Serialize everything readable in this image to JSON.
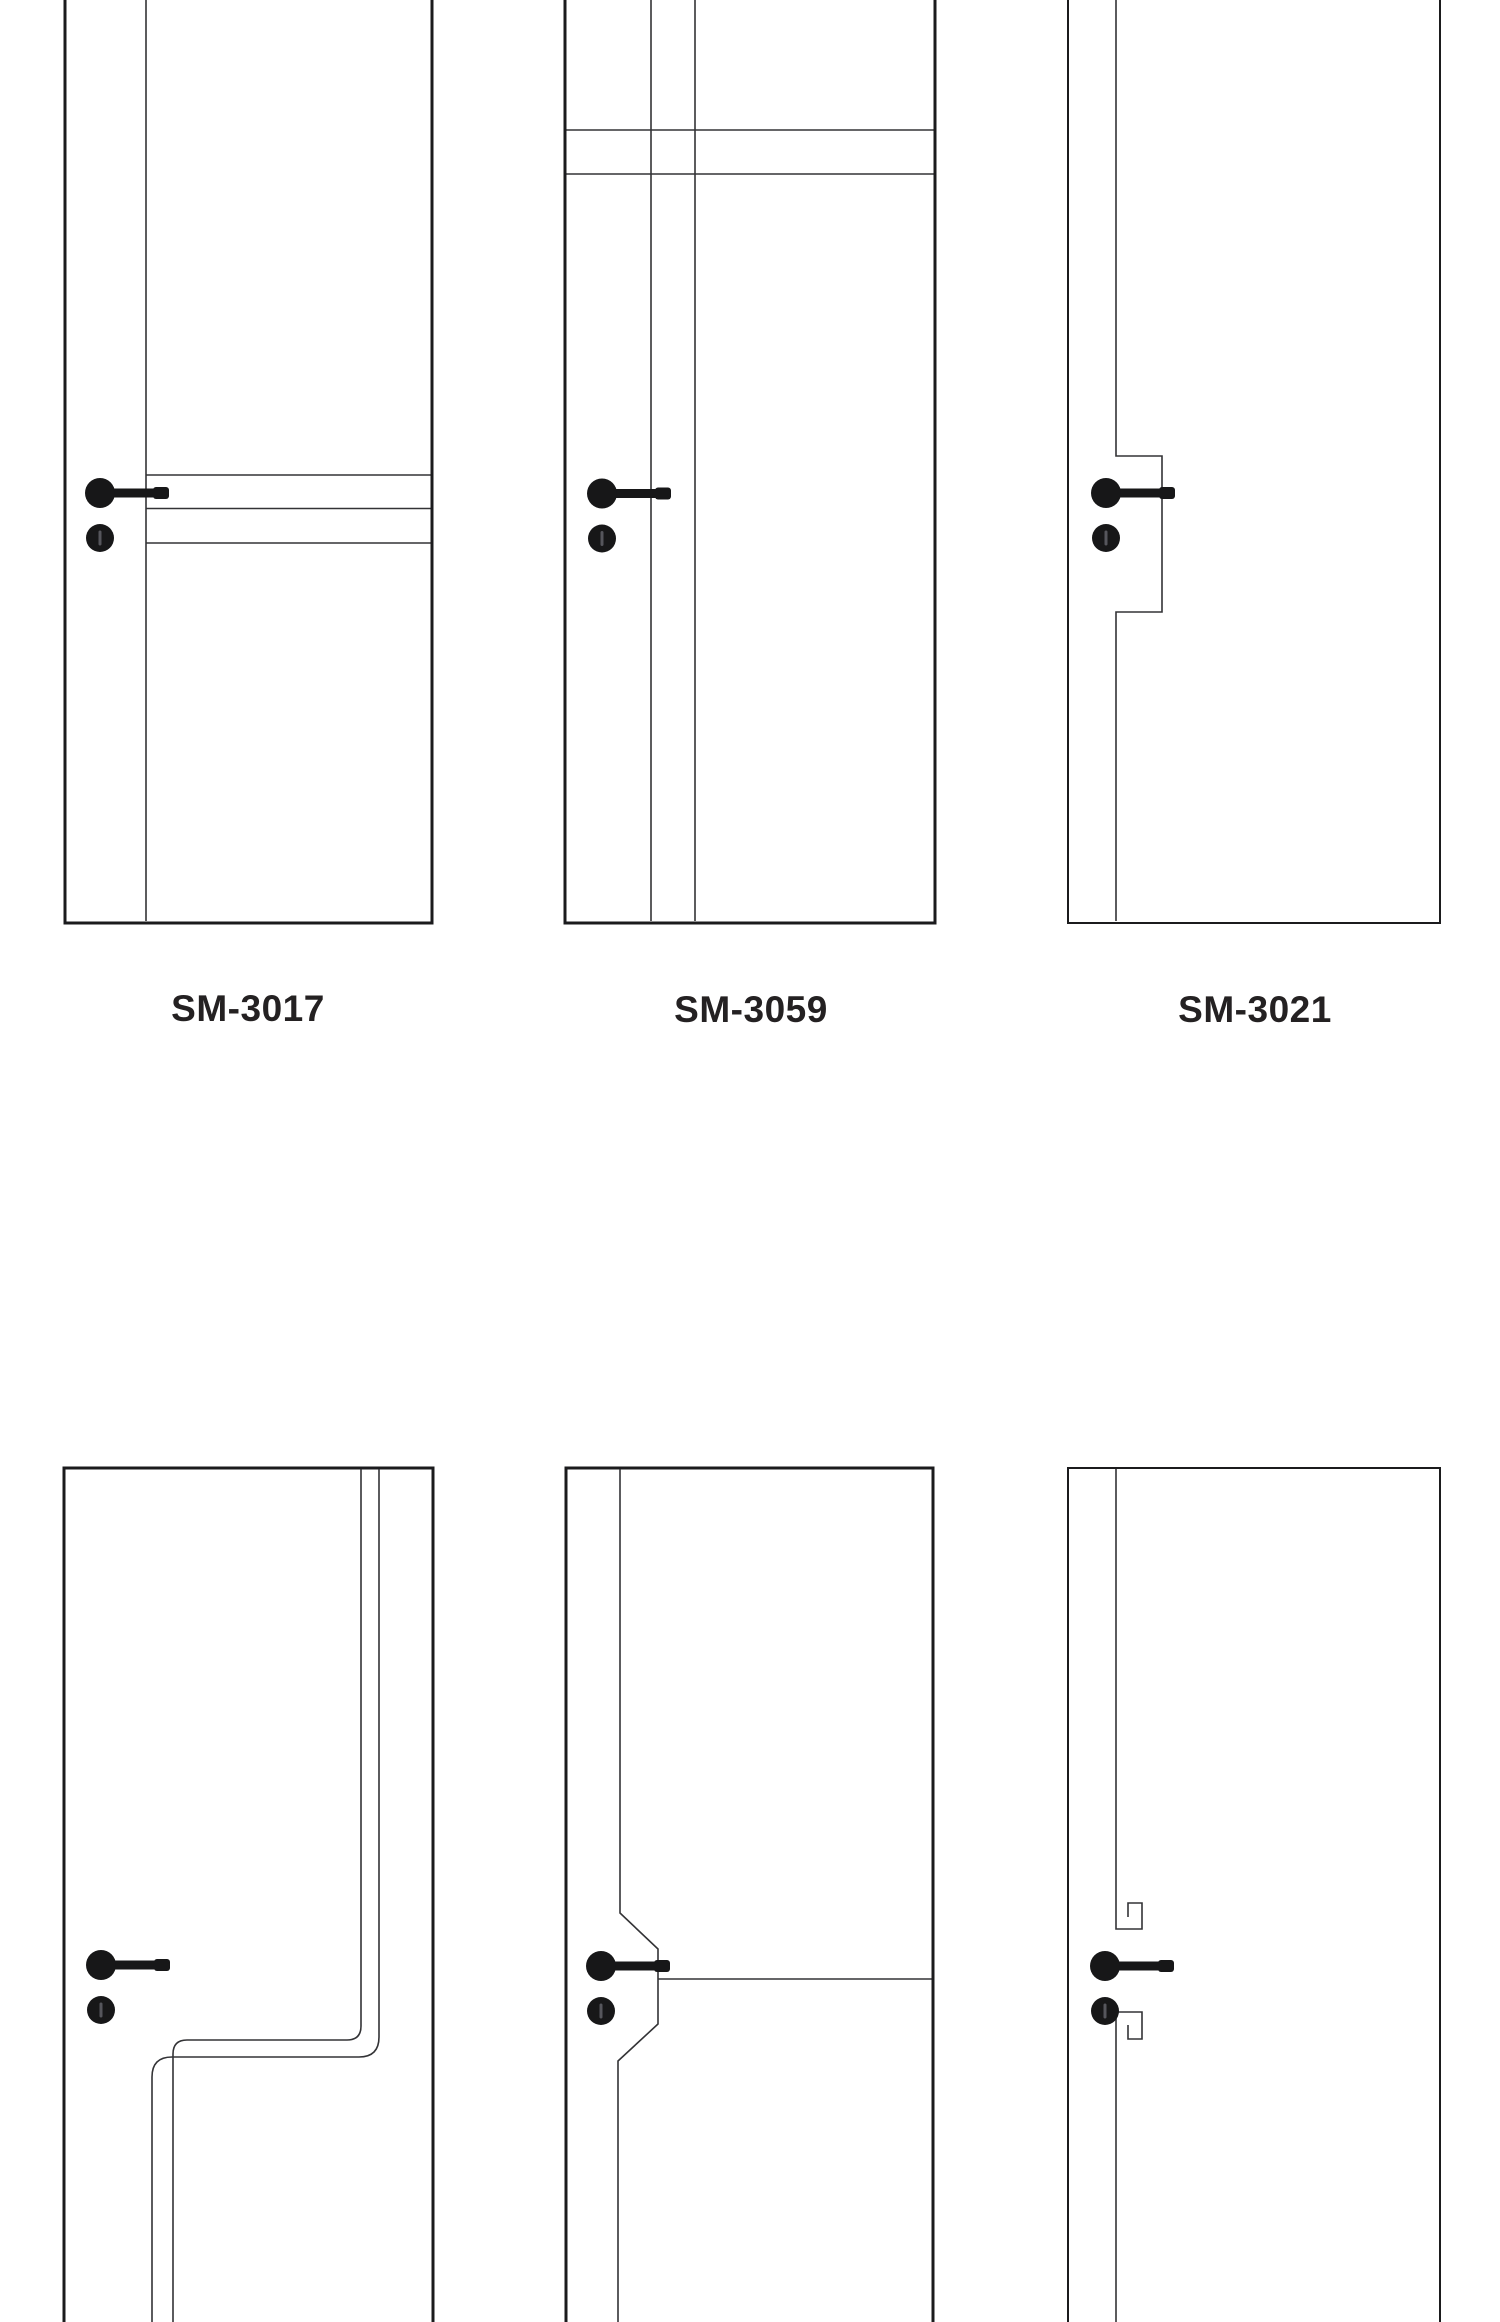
{
  "colors": {
    "bg": "#ffffff",
    "line": "#1b1b1d",
    "groove": "#333336",
    "label": "#242122",
    "handle": "#171718"
  },
  "catalog": {
    "products": [
      {
        "model": "SM-3017"
      },
      {
        "model": "SM-3059"
      },
      {
        "model": "SM-3021"
      }
    ],
    "icons": {
      "handle": "door-lever-handle-icon"
    }
  }
}
